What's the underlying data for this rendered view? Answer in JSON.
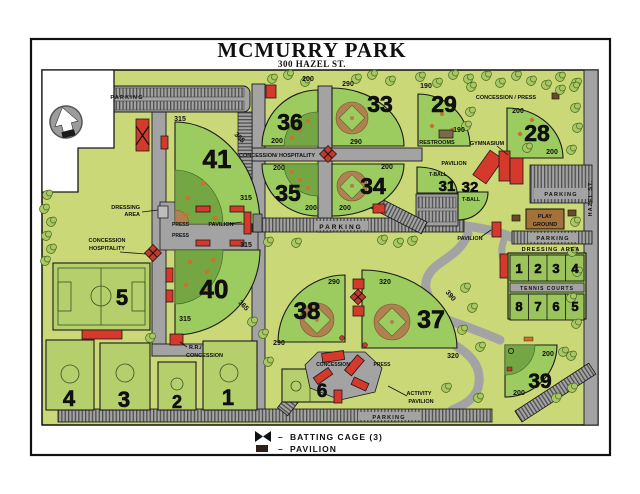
{
  "title": "MCMURRY PARK",
  "subtitle": "300 HAZEL ST.",
  "street_name": "HAZEL ST.",
  "labels": {
    "parking": "PARKING",
    "concession_hospitality": "CONCESSION/  HOSPITALITY",
    "concession": "CONCESSION",
    "hospitality": "HOSPITALITY",
    "dressing": "DRESSING",
    "area": "AREA",
    "dressing_area": "DRESSING  AREA",
    "press": "PRESS",
    "pavilion": "PAVILION",
    "restrooms": "RESTROOMS",
    "gymnasium": "GYMNASIUM",
    "concession_press": "CONCESSION  /  PRESS",
    "tball": "T-BALL",
    "play": "PLAY",
    "ground": "GROUND",
    "tennis_courts": "TENNIS  COURTS",
    "rr": "R.R./",
    "activity": "ACTIVITY"
  },
  "fields": {
    "f41": {
      "num": "41",
      "marker_top": "315",
      "marker_diag": "365",
      "marker_bottom": "315"
    },
    "f40": {
      "num": "40",
      "marker_top": "315",
      "marker_diag": "365",
      "marker_bottom": "315"
    },
    "f36": {
      "num": "36",
      "marker_a": "200",
      "marker_b": "200"
    },
    "f35": {
      "num": "35",
      "marker_a": "200",
      "marker_b": "200"
    },
    "f33": {
      "num": "33",
      "marker_a": "290",
      "marker_b": "290"
    },
    "f34": {
      "num": "34",
      "marker_a": "200",
      "marker_b": "200"
    },
    "f29": {
      "num": "29",
      "marker_a": "190",
      "marker_b": "190"
    },
    "f28": {
      "num": "28",
      "marker_a": "200",
      "marker_b": "200"
    },
    "f31": {
      "num": "31"
    },
    "f32": {
      "num": "32"
    },
    "f38": {
      "num": "38",
      "marker_a": "290",
      "marker_b": "290"
    },
    "f37": {
      "num": "37",
      "marker_a": "320",
      "marker_diag": "390",
      "marker_b": "320"
    },
    "f39": {
      "num": "39",
      "marker_a": "200",
      "marker_b": "200"
    },
    "f5": {
      "num": "5"
    },
    "f6": {
      "num": "6"
    },
    "f4": {
      "num": "4"
    },
    "f3": {
      "num": "3"
    },
    "f2": {
      "num": "2"
    },
    "f1": {
      "num": "1"
    }
  },
  "tennis": {
    "top_row": [
      "1",
      "2",
      "3",
      "4"
    ],
    "bottom_row": [
      "8",
      "7",
      "6",
      "5"
    ]
  },
  "legend": {
    "dash": "–",
    "batting_cage": "BATTING  CAGE  (3)",
    "pavilion": "PAVILION"
  },
  "colors": {
    "map_background": "#cbd878",
    "field_green": "#9ccb5f",
    "field_dark_green": "#74a743",
    "court_green": "#b6cf6d",
    "infield_brown": "#b08050",
    "road_gray": "#a3a3a3",
    "building_red": "#d4392b",
    "playground_brown": "#a5713a",
    "tree_green": "#aac763"
  }
}
